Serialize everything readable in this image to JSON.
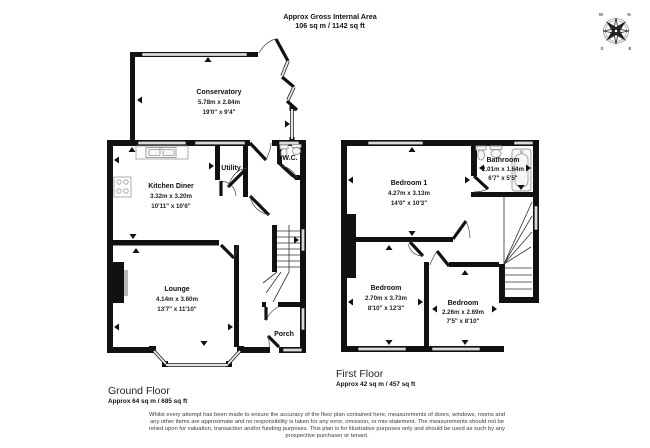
{
  "header": {
    "title": "Approx Gross Internal Area",
    "area": "106 sq m / 1142 sq ft"
  },
  "compass": {
    "n": "N",
    "e": "E",
    "s": "S",
    "w": "W"
  },
  "ground_floor": {
    "title": "Ground Floor",
    "area": "Approx 64 sq m / 685 sq ft",
    "rooms": {
      "conservatory": {
        "name": "Conservatory",
        "metric": "5.78m x 2.84m",
        "imperial": "19'0\" x 9'4\""
      },
      "kitchen": {
        "name": "Kitchen Diner",
        "metric": "3.32m x 3.20m",
        "imperial": "10'11\" x 10'6\""
      },
      "utility": {
        "name": "Utility"
      },
      "wc": {
        "name": "W.C."
      },
      "lounge": {
        "name": "Lounge",
        "metric": "4.14m x 3.60m",
        "imperial": "13'7\" x 11'10\""
      },
      "porch": {
        "name": "Porch"
      }
    }
  },
  "first_floor": {
    "title": "First Floor",
    "area": "Approx 42 sq m / 457 sq ft",
    "rooms": {
      "bedroom1": {
        "name": "Bedroom 1",
        "metric": "4.27m x 3.13m",
        "imperial": "14'0\" x 10'3\""
      },
      "bathroom": {
        "name": "Bathroom",
        "metric": "2.01m x 1.64m",
        "imperial": "6'7\" x 5'5\""
      },
      "bedroom2": {
        "name": "Bedroom",
        "metric": "2.70m x 3.73m",
        "imperial": "8'10\" x 12'3\""
      },
      "bedroom3": {
        "name": "Bedroom",
        "metric": "2.26m x 2.69m",
        "imperial": "7'5\" x 8'10\""
      }
    }
  },
  "disclaimer": {
    "lines": [
      "Whilst every attempt has been made to ensure the accuracy of the floor plan contained here, measurements of doors, windows, rooms and",
      "any other items are approximate and no responsibility is taken for any error, omission, or mis-statement. The measurements should not be",
      "relied upon for valuation, transaction and/or funding purposes. This plan is for illustrative purposes only and should be used as such by any",
      "prospective purchaser or tenant."
    ]
  },
  "colors": {
    "wall": "#111111",
    "window": "#d9d9d9",
    "fixture": "#999999",
    "text": "#111111"
  }
}
